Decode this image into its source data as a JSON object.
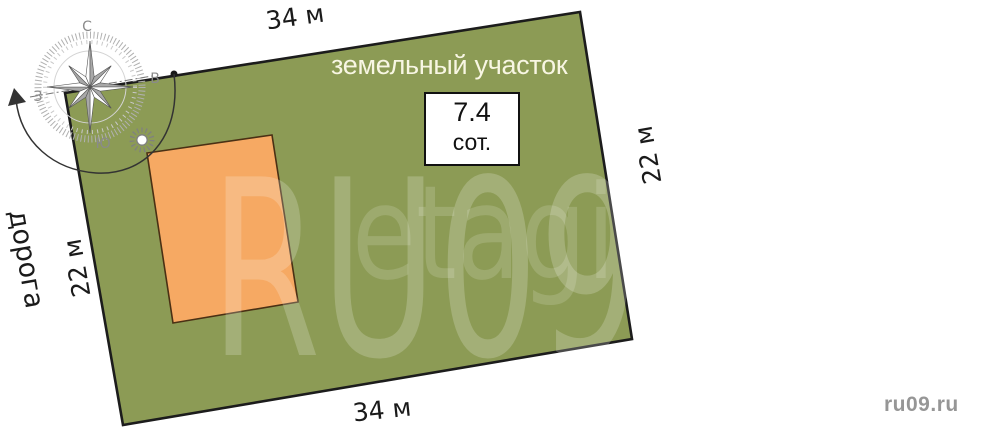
{
  "diagram": {
    "title": "земельный участок",
    "area": {
      "value": "7.4",
      "unit": "сот."
    },
    "dimensions": {
      "top": "34 м",
      "bottom": "34 м",
      "left": "22 м",
      "right": "22 м"
    },
    "road_label": "дорога",
    "colors": {
      "land": "#8c9b55",
      "building": "#f6a963",
      "outline": "#1c1c1c",
      "building_outline": "#4a3014"
    }
  },
  "compass": {
    "north_label": "С",
    "east_label": "В",
    "south_label": "Ю",
    "west_label": "З"
  },
  "watermark": {
    "primary": "RU09",
    "secondary": "etagi",
    "site_label": "ru09.ru"
  }
}
